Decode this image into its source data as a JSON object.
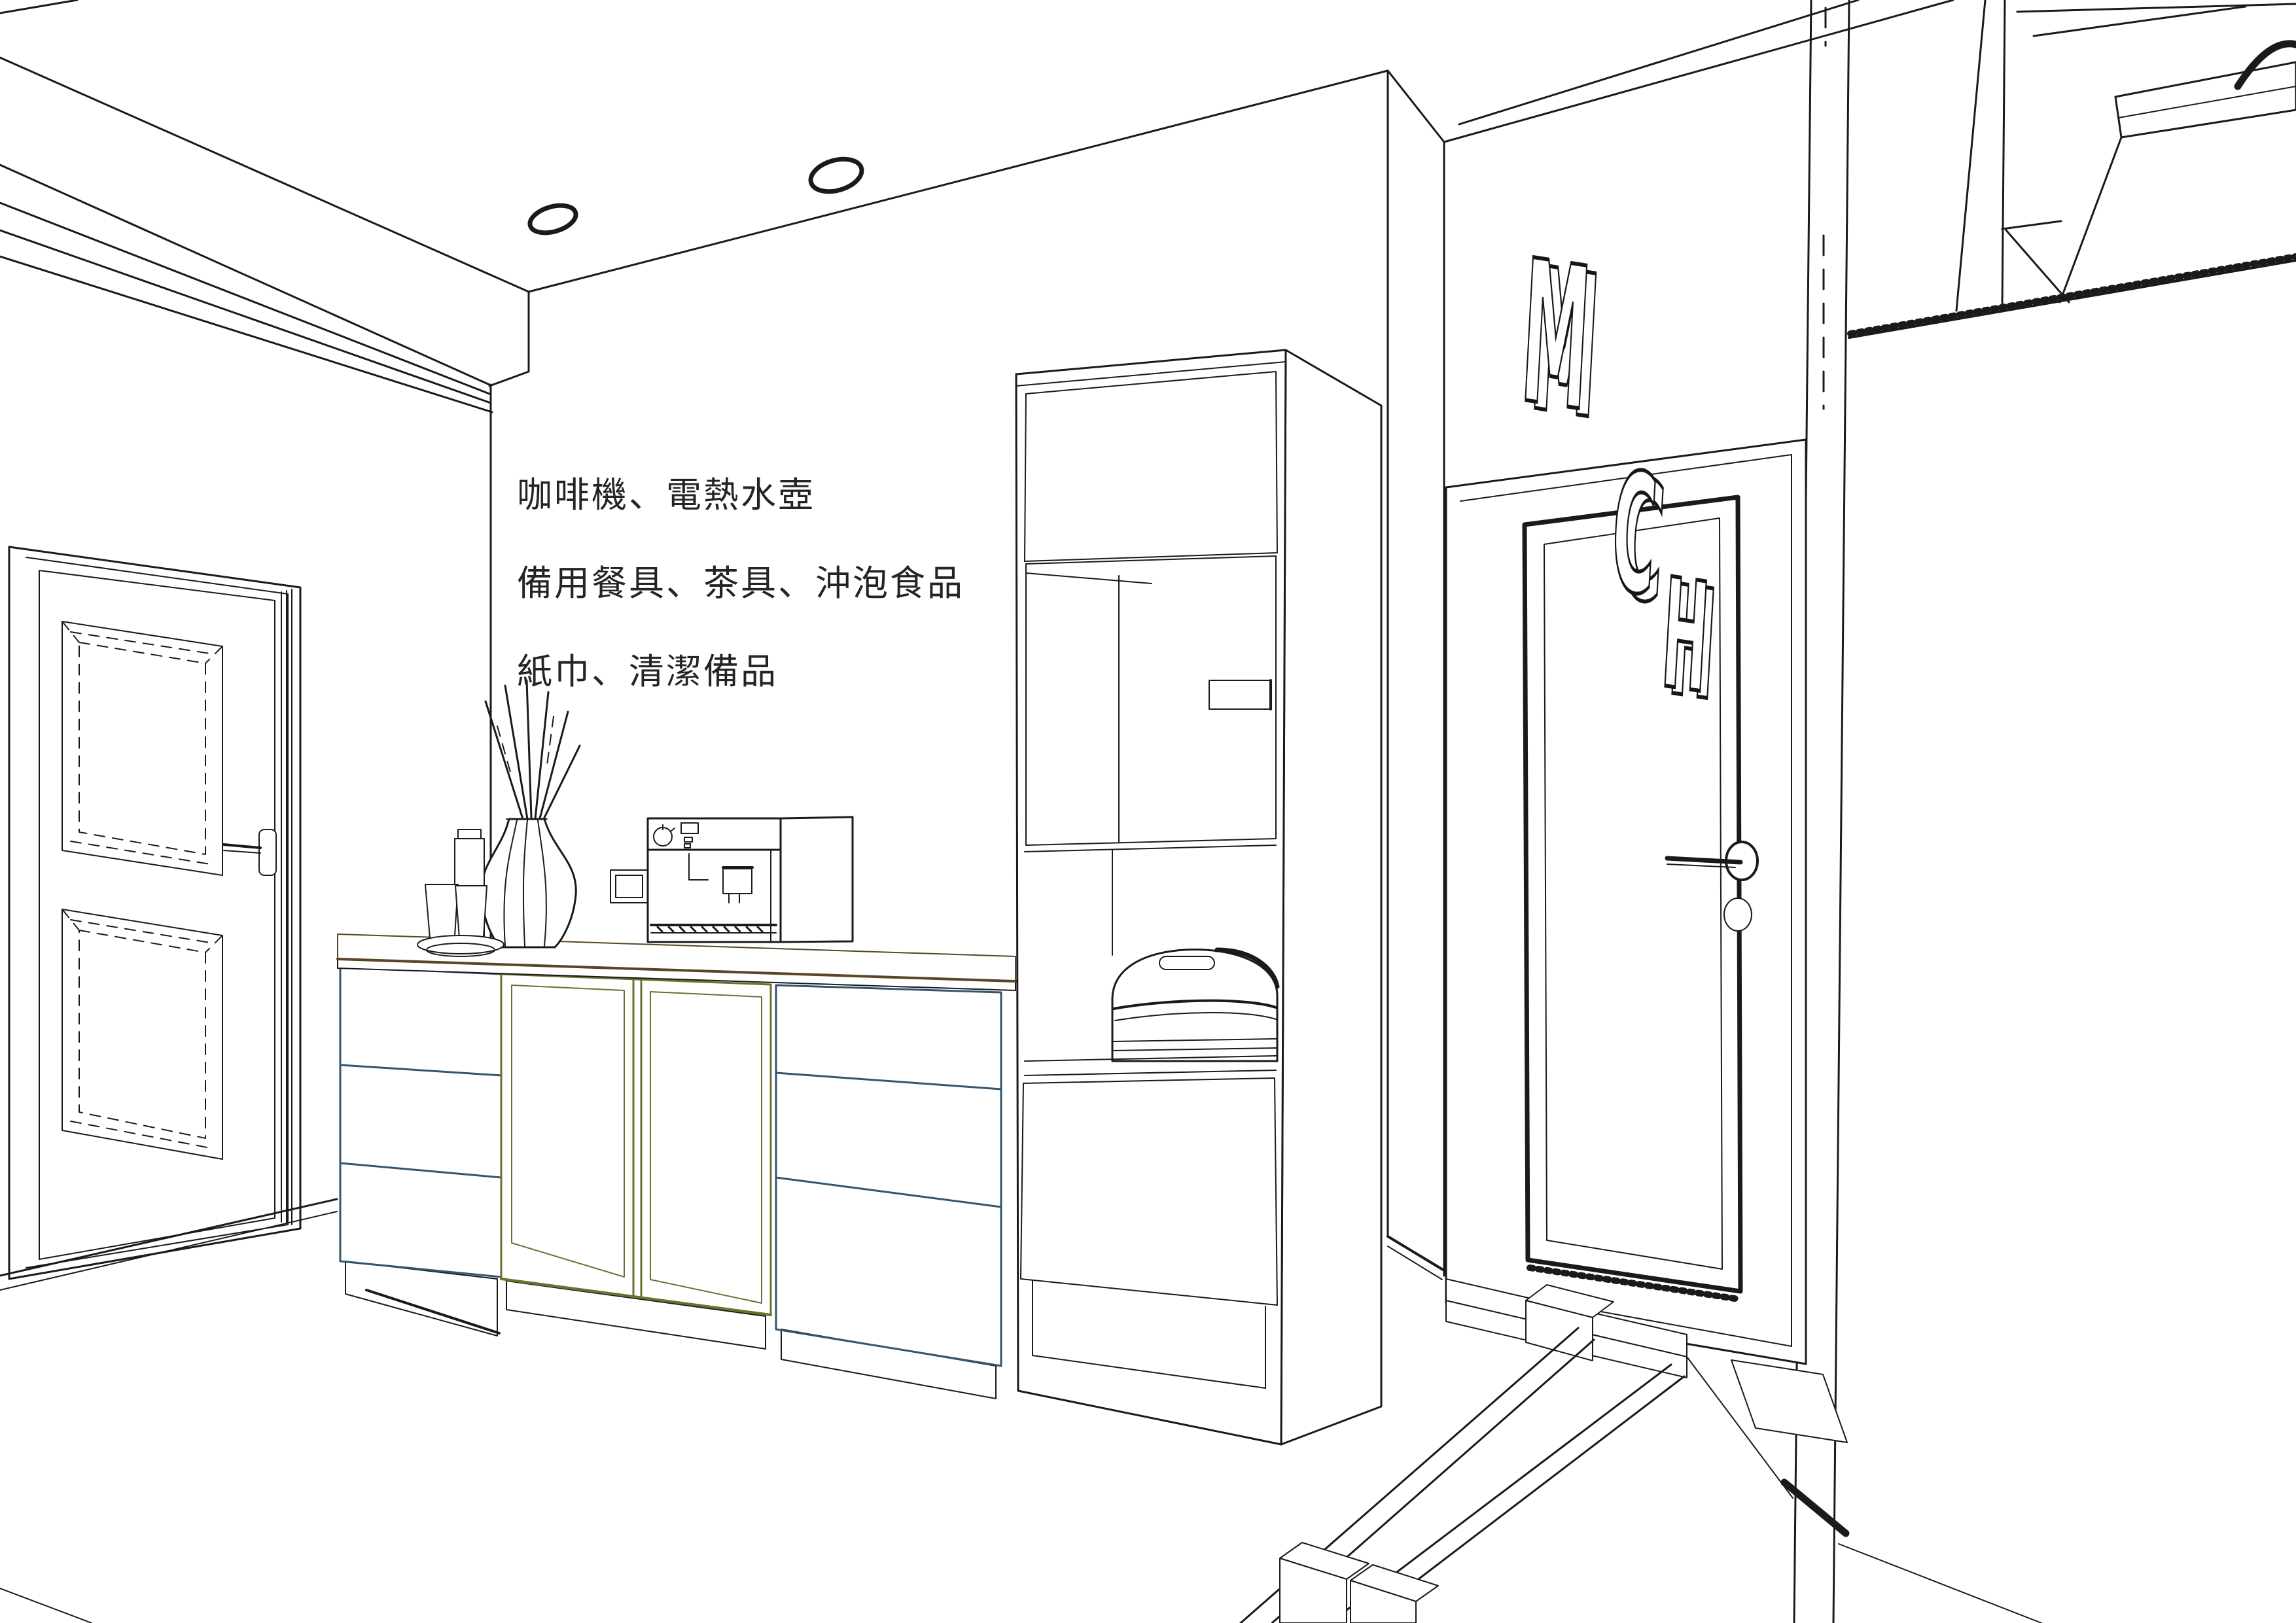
{
  "legend": {
    "items": [
      {
        "color": "#f2d8b0",
        "label": "咖啡機、電熱水壺"
      },
      {
        "color": "#cde1ef",
        "label": "備用餐具、茶具、沖泡食品"
      },
      {
        "color": "#f0f2a2",
        "label": "紙巾、清潔備品"
      }
    ]
  },
  "sign": {
    "letters": [
      "M",
      "C",
      "H"
    ]
  },
  "colors": {
    "countertop_tan": "#f6dfc0",
    "cabinet_blue": "#d4e5f1",
    "cabinet_yellow": "#eef3a4",
    "line_dark": "#1a1a1a"
  }
}
